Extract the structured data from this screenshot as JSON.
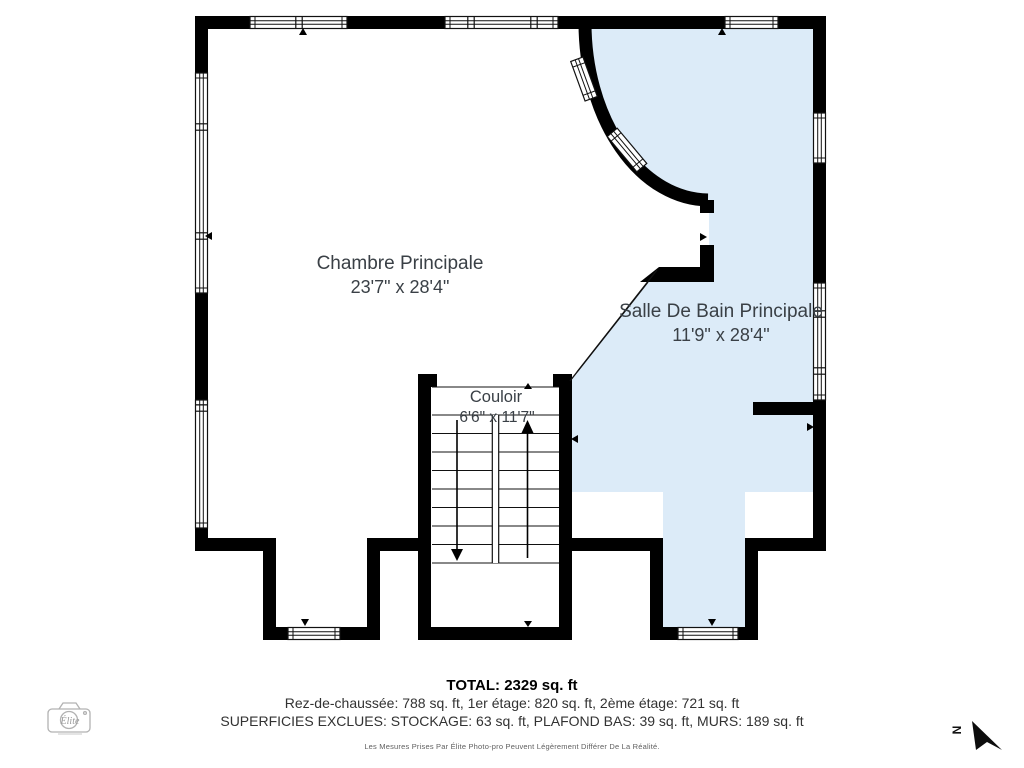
{
  "plan": {
    "rooms": [
      {
        "name": "Chambre Principale",
        "dims": "23'7\" x 28'4\""
      },
      {
        "name": "Salle De Bain Principale",
        "dims": "11'9\" x 28'4\""
      },
      {
        "name": "Couloir",
        "dims": "6'6\" x 11'7\""
      }
    ],
    "colors": {
      "bathroom_fill": "#dcebf8",
      "wall": "#000000",
      "label_text": "#3a4046"
    }
  },
  "summary": {
    "total": "TOTAL: 2329 sq. ft",
    "floors": "Rez-de-chaussée: 788 sq. ft, 1er étage: 820 sq. ft, 2ème étage: 721 sq. ft",
    "exclusions": "SUPERFICIES EXCLUES: STOCKAGE: 63 sq. ft, PLAFOND BAS: 39 sq. ft, MURS: 189 sq. ft"
  },
  "disclaimer": "Les Mesures Prises Par Élite Photo-pro Peuvent Légèrement Différer De La Réalité.",
  "compass": {
    "label": "N"
  },
  "logo": {
    "text": "Élite"
  }
}
